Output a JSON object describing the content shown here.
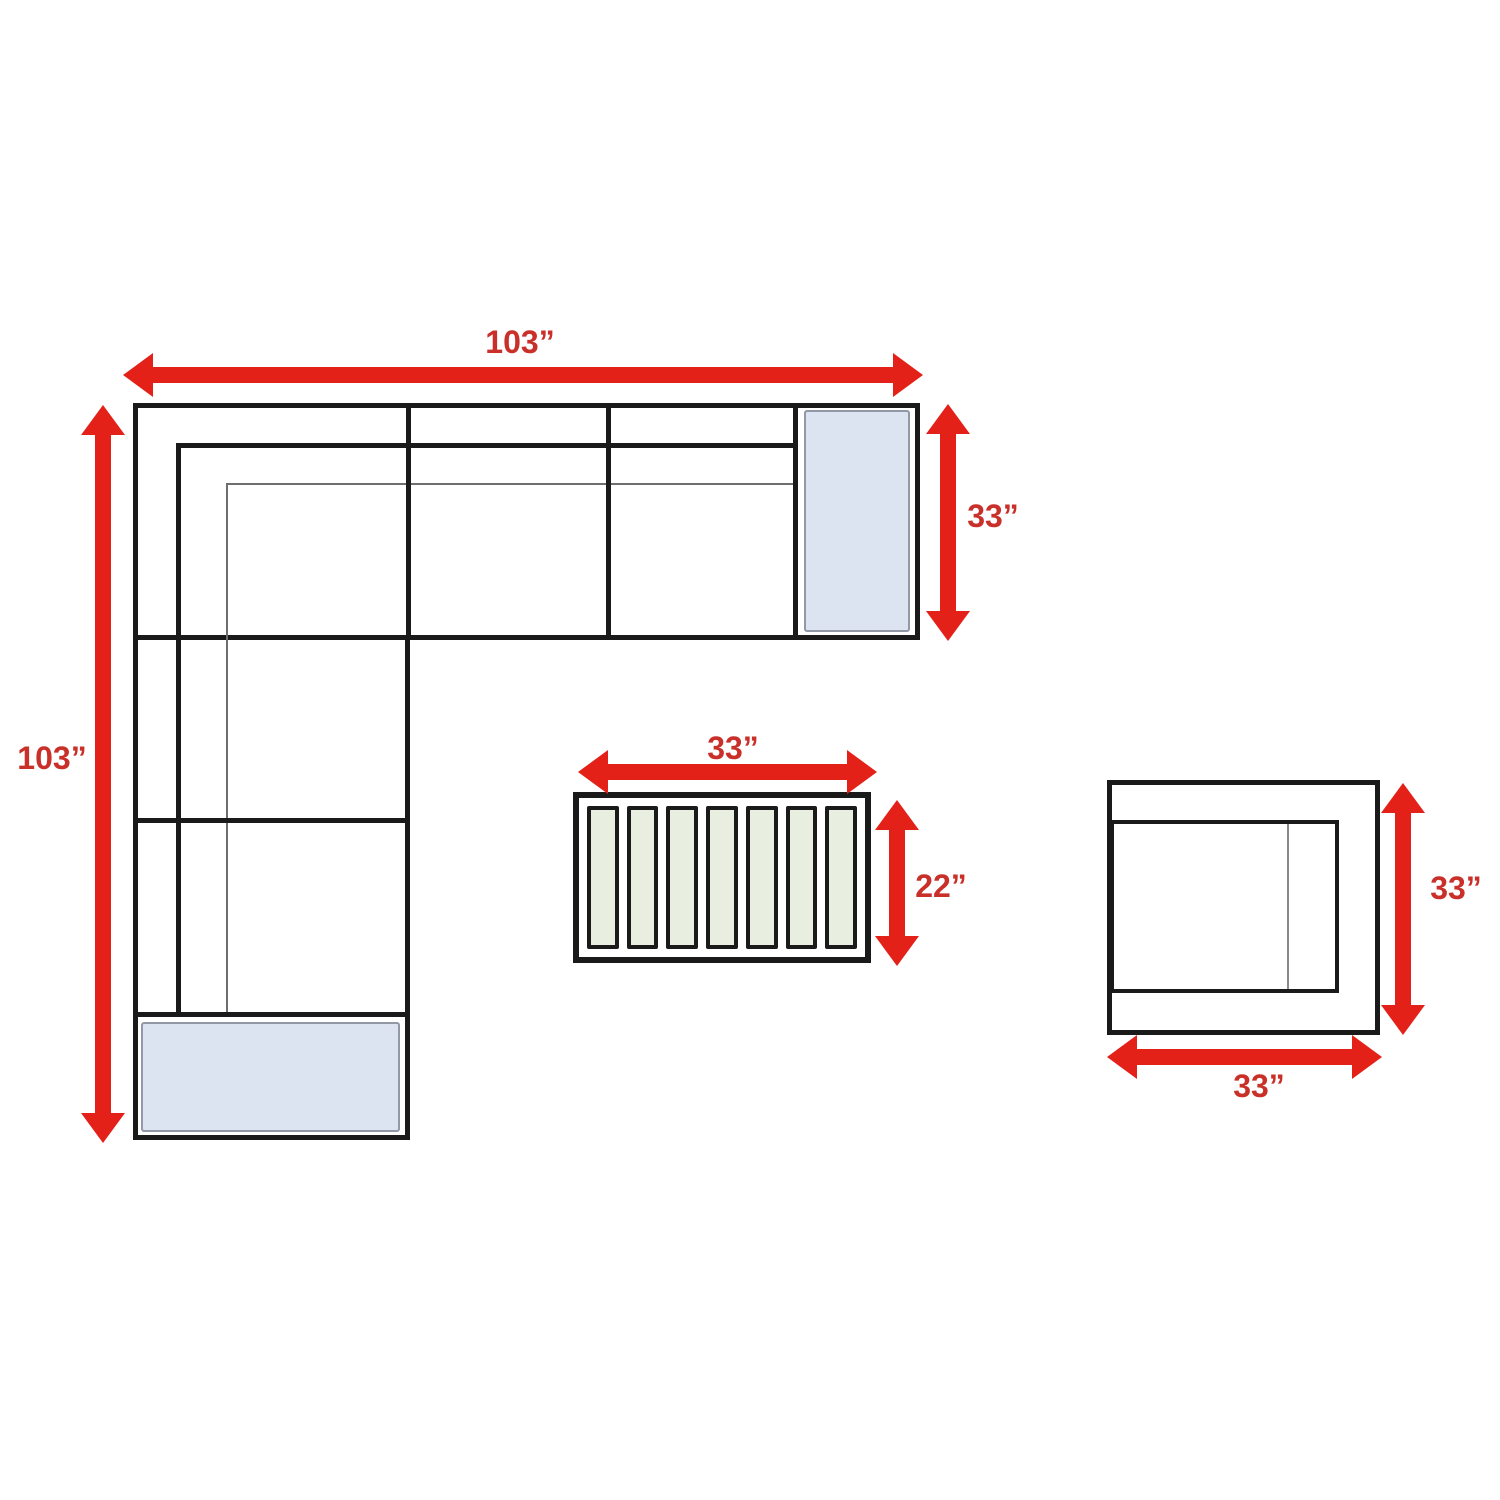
{
  "diagram": {
    "sofa": {
      "width_label": "103”",
      "height_label": "103”",
      "chaise_depth_label": "33”"
    },
    "coffee_table": {
      "width_label": "33”",
      "depth_label": "22”",
      "slat_count": 7
    },
    "chair": {
      "depth_label": "33”",
      "width_label": "33”"
    },
    "colors": {
      "arrow_red": "#e32119",
      "label_red": "#c9302a",
      "outline_black": "#1a1a1a",
      "thin_line_gray": "#6e6e6e",
      "cushion_blue": "#dce3f1",
      "cushion_border": "#9298a5",
      "slat_green": "#e8efe0",
      "background": "#ffffff"
    }
  }
}
